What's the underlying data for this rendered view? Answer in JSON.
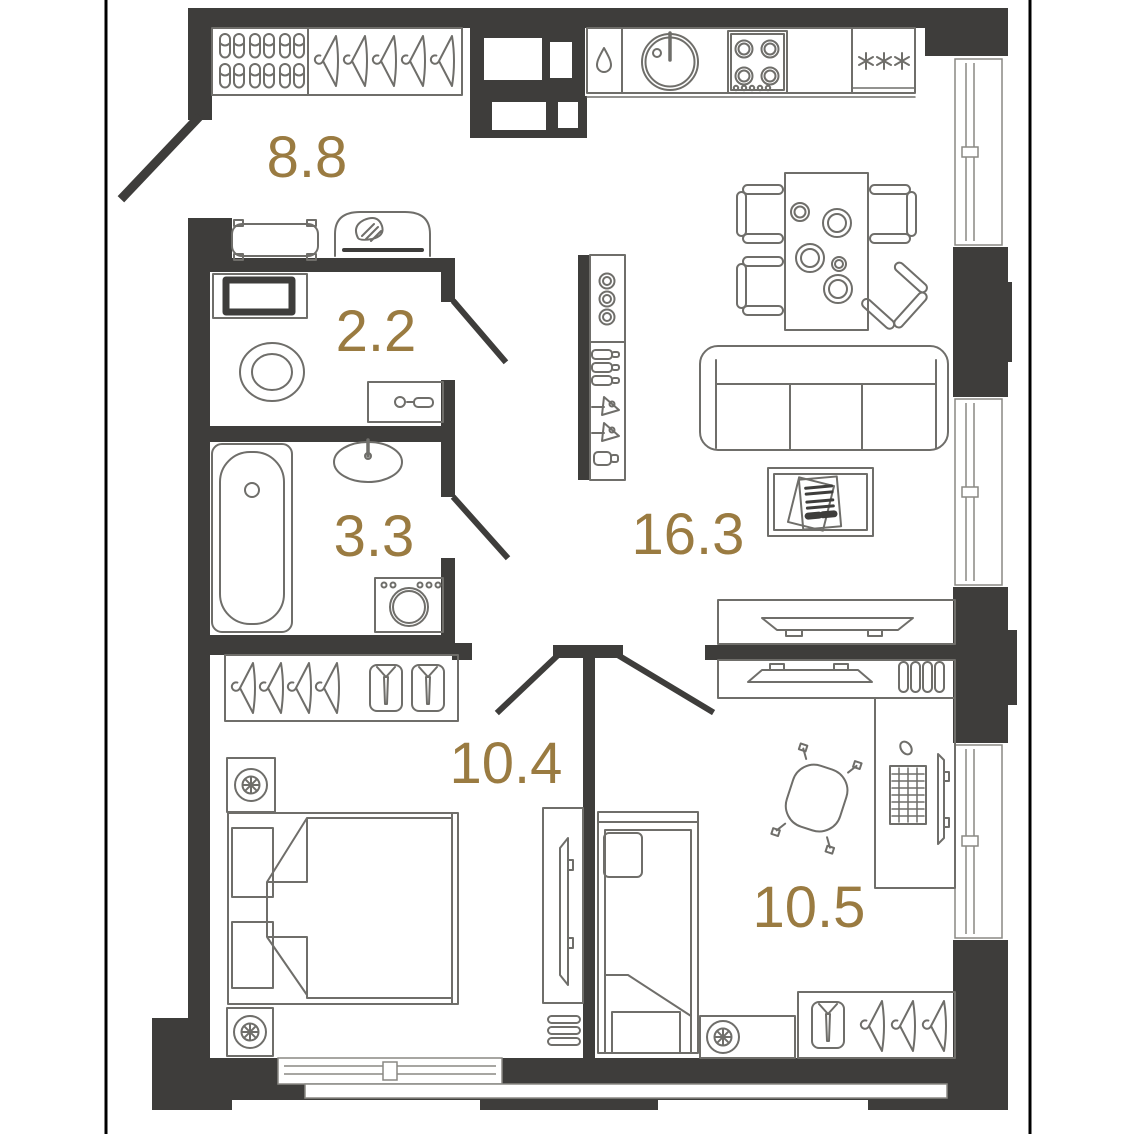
{
  "floor_plan": {
    "rooms": {
      "hallway": {
        "area": "8.8"
      },
      "wc": {
        "area": "2.2"
      },
      "bathroom": {
        "area": "3.3"
      },
      "living_kitchen": {
        "area": "16.3"
      },
      "bedroom": {
        "area": "10.4"
      },
      "bedroom_2": {
        "area": "10.5"
      }
    },
    "colors": {
      "wall": "#3e3d3b",
      "area_label": "#9a7b41",
      "furniture_line": "#6f6e6a",
      "boundary_line": "#000000"
    },
    "icons": [
      "slippers-icon",
      "hanger-icon",
      "shirt-icon",
      "bench-icon",
      "console-mirror-icon",
      "ventilation-shaft-icon",
      "dishwasher-drop-icon",
      "kitchen-sink-icon",
      "stove-icon",
      "fridge-freezer-icon",
      "freezer-asterisk-icon",
      "dining-table-icon",
      "chair-icon",
      "plate-icon",
      "sofa-icon",
      "coffee-table-icon",
      "magazine-icon",
      "tv-icon",
      "tv-stand-icon",
      "bar-shelf-icon",
      "glass-icon",
      "bottle-icon",
      "martini-icon",
      "shaker-icon",
      "washing-machine-icon",
      "cabinet-icon",
      "toilet-icon",
      "wash-basin-icon",
      "bathtub-icon",
      "double-bed-icon",
      "single-bed-icon",
      "pillow-icon",
      "nightstand-lamp-icon",
      "wardrobe-icon",
      "desk-icon",
      "office-chair-icon",
      "monitor-icon",
      "keyboard-icon",
      "mouse-icon",
      "door-leaf-icon",
      "window-icon",
      "slat-shelf-icon"
    ]
  }
}
